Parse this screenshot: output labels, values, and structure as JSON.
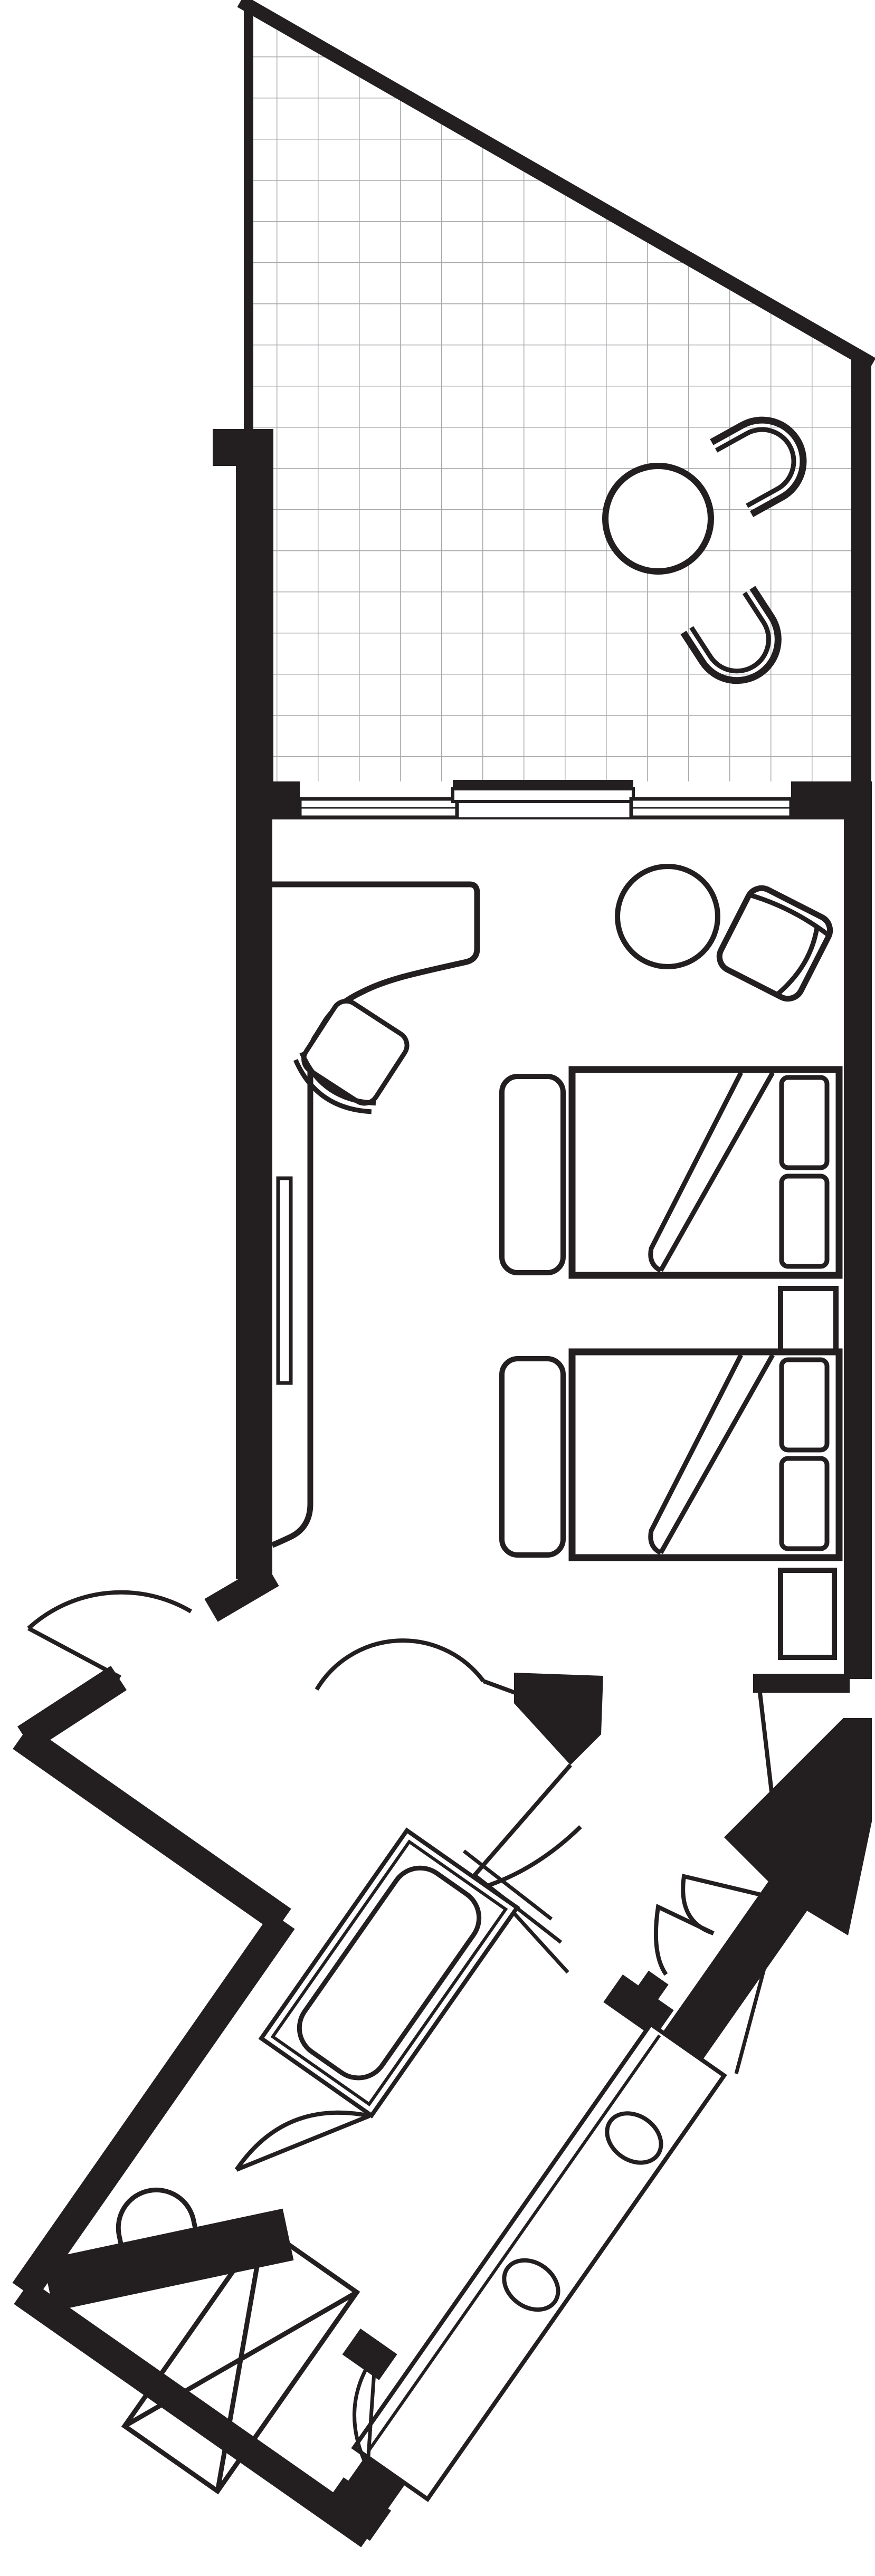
{
  "meta": {
    "type": "architectural floor plan",
    "subject": "hotel guest room with triangular tiled terrace, twin-bed room and angled bathroom wing",
    "orientation": "terrace at top, bedroom in middle, rotated bathroom wing at bottom-left",
    "drawing_style": "black and white line drawing, no text labels"
  },
  "colors": {
    "background": "#ffffff",
    "walls": "#231f20",
    "tile_grid": "#a7a9ac",
    "furniture_fill": "#ffffff"
  },
  "areas": {
    "terrace": "Tiled terrace with angled glass front",
    "bedroom": "Twin bedroom with desk and sitting corner",
    "entry": "Entry vestibule with double swing doors",
    "bathroom": "Bathroom wing rotated 35 degrees",
    "closet": "Hall closet with folding doors"
  },
  "labels": {
    "terrace": "Terrace",
    "tile-floor": "Tiled terrace floor",
    "terrace-table": "Round terrace table",
    "terrace-chair-1": "Terrace chair",
    "terrace-chair-2": "Terrace chair",
    "window-left": "Fixed window",
    "window-right": "Fixed window",
    "sliding-door": "Sliding terrace door",
    "desk": "Built-in desk / console",
    "tv": "Television on console",
    "desk-chair": "Desk chair",
    "side-table": "Round side table",
    "armchair": "Lounge armchair",
    "bench-1": "Luggage bench",
    "bed-1": "Twin bed with turned-down cover",
    "pillow": "Pillow",
    "nightstand": "Nightstand",
    "bed-2": "Twin bed with turned-down cover",
    "bench-2": "Luggage bench",
    "luggage-rack": "Luggage rack",
    "entry-door": "Entry double swing door",
    "bathroom-door": "Bathroom door",
    "closet-doors": "Closet folding doors",
    "bathtub": "Bathtub",
    "glass-screen": "Glass partition",
    "vanity": "Vanity counter with two basins",
    "sink-1": "Wash basin",
    "sink-2": "Wash basin",
    "toilet": "Toilet",
    "toilet-door": "WC door",
    "wardrobe": "Wardrobe (crossed shelf symbol)",
    "tip-closet": "Corner storage door"
  }
}
